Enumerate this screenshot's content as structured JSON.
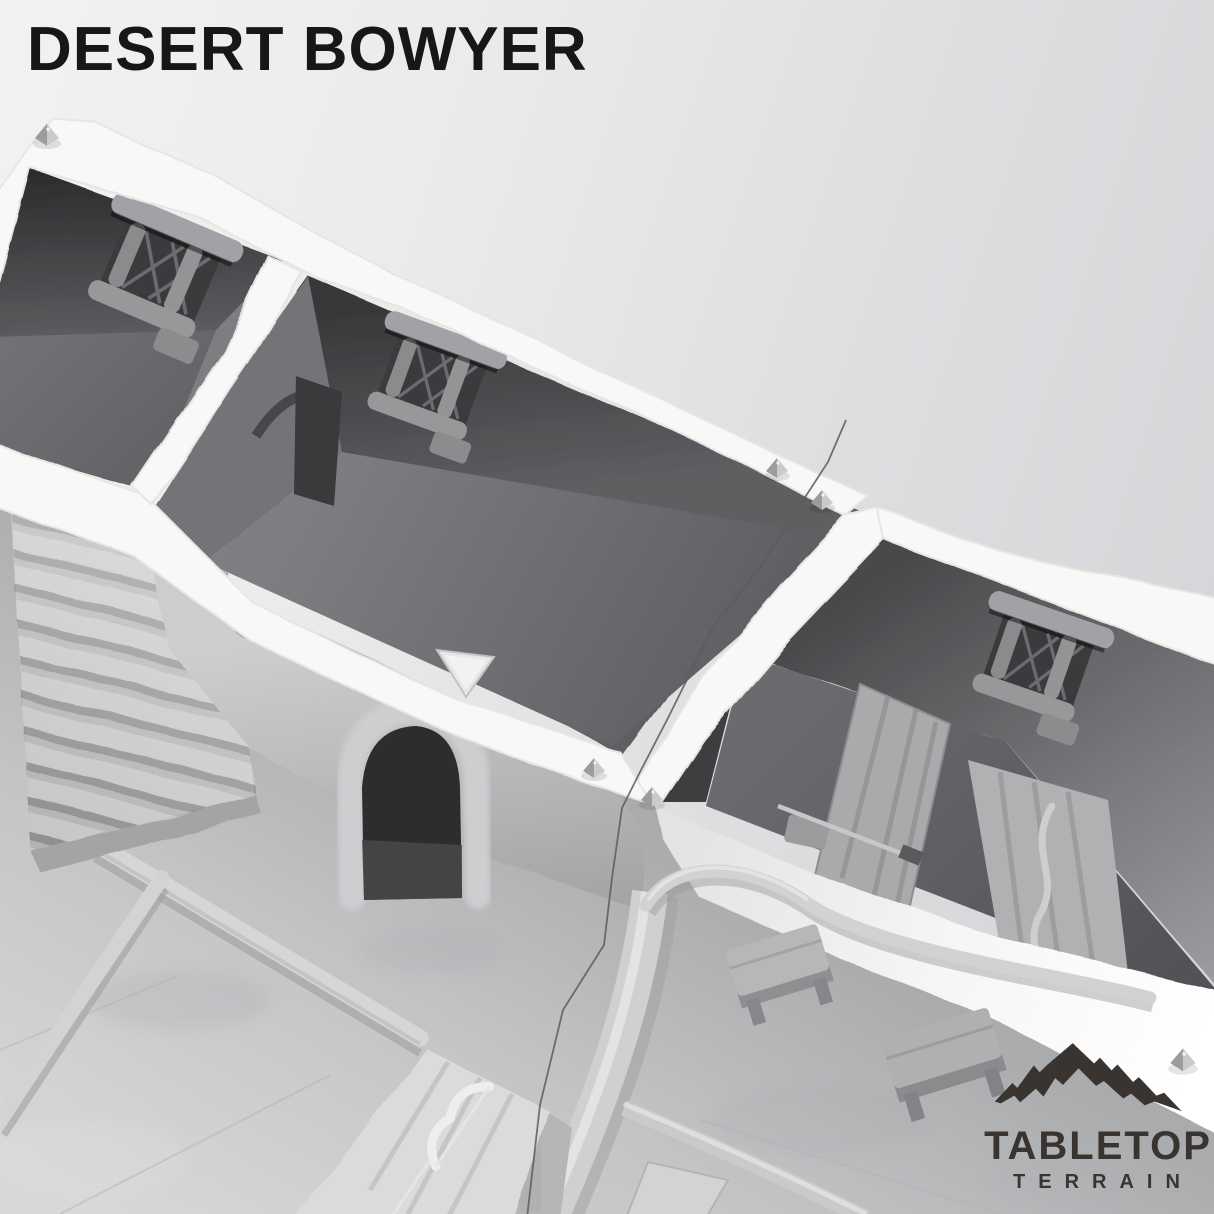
{
  "title": "DESERT BOWYER",
  "logo": {
    "line1": "TABLETOP",
    "line2": "TERRAIN",
    "icon": "mountain-range-icon",
    "text_color": "#3a3431"
  },
  "colors": {
    "background_top_left": "#f3f2f1",
    "background_right": "#d2d3d6",
    "title_text": "#181716",
    "wall_top_white": "#f8f8f6",
    "room_wall_dark": "#3a3a3c",
    "room_floor_gray": "#68696c",
    "lower_floor_light": "#cbccce",
    "stair_tread": "#c5c6c8"
  }
}
